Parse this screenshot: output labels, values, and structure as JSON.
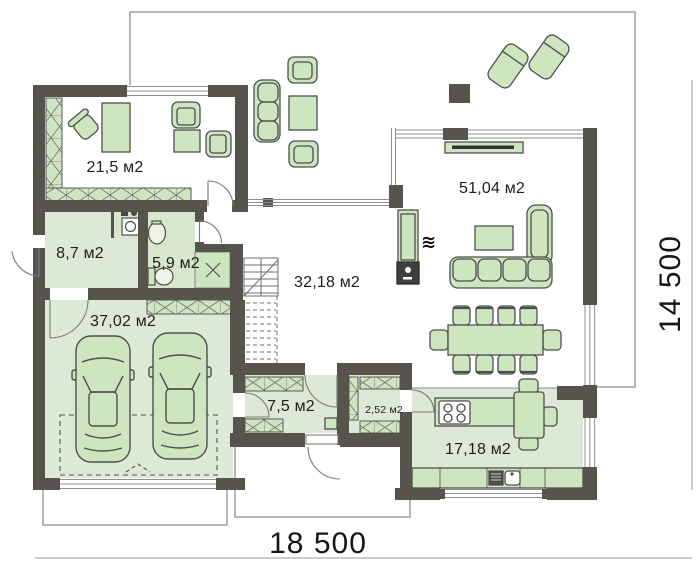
{
  "plan": {
    "type": "single-storey house floor plan",
    "overall_dimensions": {
      "width": "18 500",
      "depth": "14 500"
    },
    "rooms": {
      "study": {
        "area": "21,5 м2"
      },
      "living_room": {
        "area": "51,04 м2"
      },
      "utility": {
        "area": "8,7 м2"
      },
      "bathroom": {
        "area": "5,9 м2"
      },
      "hall": {
        "area": "32,18 м2"
      },
      "garage": {
        "area": "37,02 м2"
      },
      "entry": {
        "area": "7,5 м2"
      },
      "pantry": {
        "area": "2,52 м2"
      },
      "kitchen": {
        "area": "17,18 м2"
      }
    },
    "icons": {
      "heat_waves": "≋"
    },
    "furniture": [
      "desk",
      "office-chair",
      "armchairs",
      "wardrobes",
      "outdoor-sofa-set",
      "sun-loungers",
      "tv-bench",
      "fireplace",
      "corner-sofa",
      "coffee-table",
      "dining-table-8-chairs",
      "kitchen-island-stove",
      "kitchen-counter-sink",
      "washing-machine",
      "sink",
      "toilet",
      "two-cars",
      "staircase"
    ],
    "colors": {
      "wall": "#57534d",
      "floor": "#dde9d6",
      "furniture_fill": "#cde6c0",
      "furniture_stroke": "#4e4e4e",
      "outline": "#8f8f8f",
      "text": "#1b1b1b"
    }
  }
}
